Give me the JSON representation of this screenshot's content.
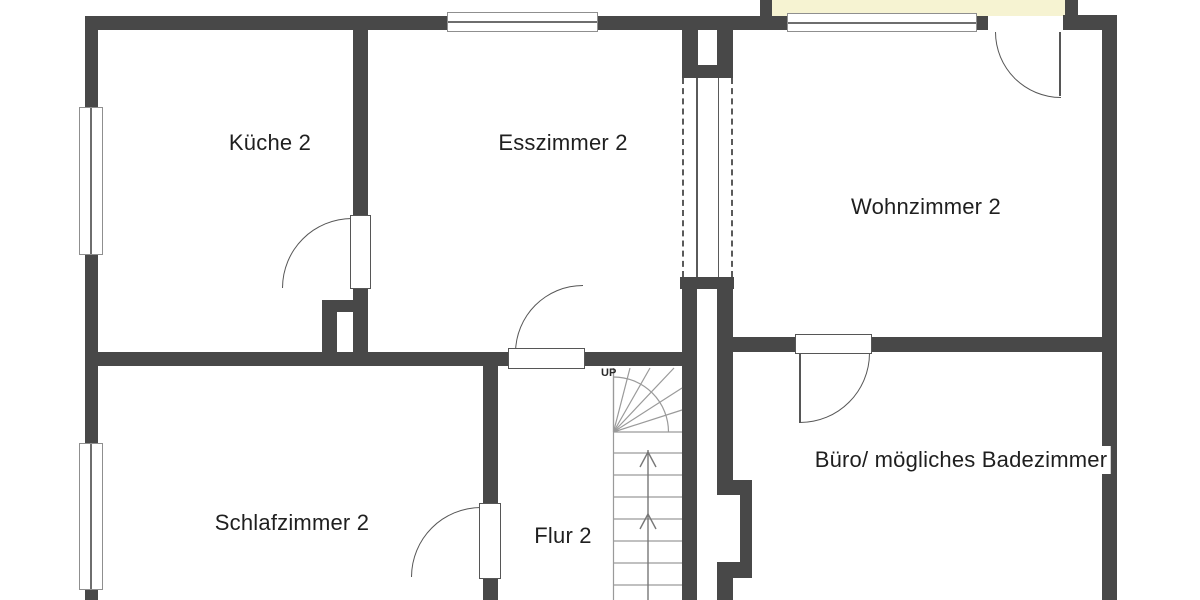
{
  "plan_type": "floor-plan",
  "rooms": [
    {
      "id": "kueche",
      "label": "Küche 2"
    },
    {
      "id": "esszimmer",
      "label": "Esszimmer 2"
    },
    {
      "id": "wohnzimmer",
      "label": "Wohnzimmer 2"
    },
    {
      "id": "schlafzimmer",
      "label": "Schlafzimmer 2"
    },
    {
      "id": "flur",
      "label": "Flur 2"
    },
    {
      "id": "buero",
      "label": "Büro/ mögliches Badezimmer"
    }
  ],
  "stairs": {
    "direction_label": "UP"
  },
  "colors": {
    "wall": "#484848",
    "balcony_fill": "#f6f3d2",
    "stair_line": "#999999",
    "door_line": "#565656",
    "text": "#1f1f1f",
    "background": "#ffffff"
  }
}
